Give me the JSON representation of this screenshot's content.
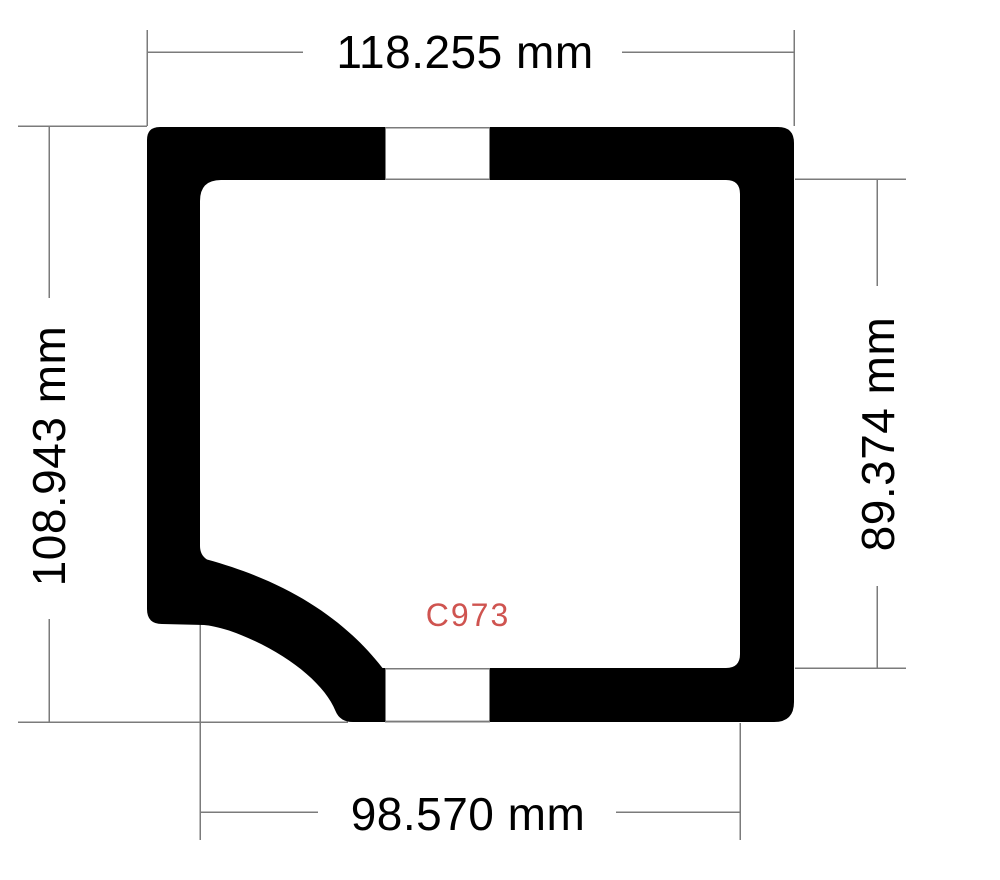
{
  "drawing": {
    "title": "gasket-profile-drawing",
    "part_label": "C973",
    "dimensions": {
      "top": "118.255 mm",
      "left": "108.943 mm",
      "right": "89.374 mm",
      "bottom": "98.570 mm"
    },
    "colors": {
      "shape": "#000000",
      "line": "#7b7b7b",
      "text": "#000000",
      "part_label": "#cf5450",
      "background": "#ffffff"
    }
  }
}
